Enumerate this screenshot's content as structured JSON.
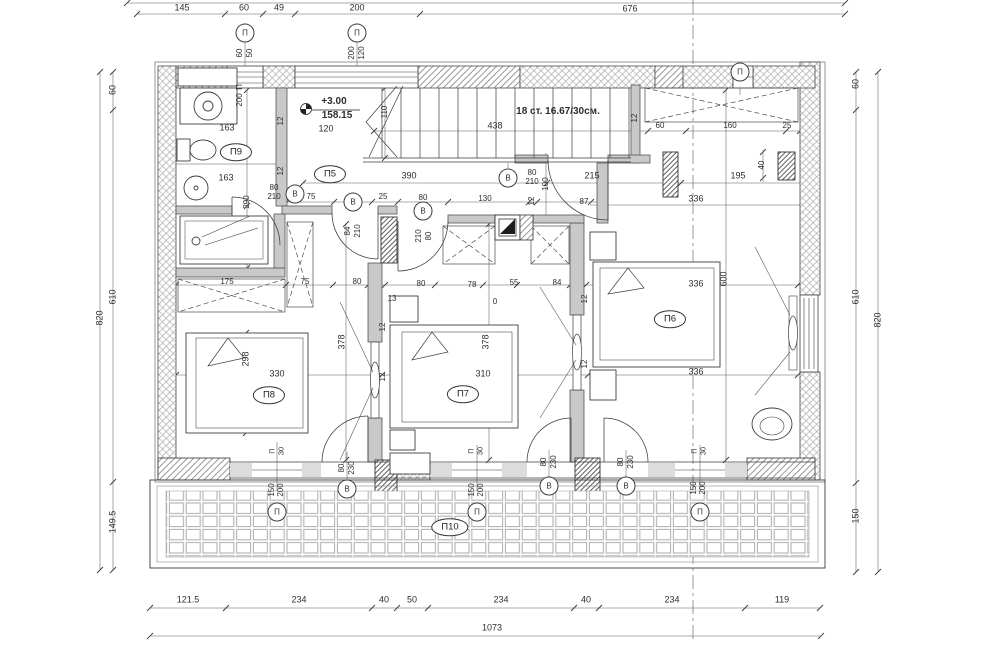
{
  "plan": {
    "title": "Floor plan +3.00 (second storey) with terrace",
    "level_mark": {
      "relative_elevation": "+3.00",
      "absolute_elevation": "158.15"
    },
    "stairs": {
      "note": "18 ст. 16.67/30см.",
      "run_length": "438",
      "flight_width": "110"
    },
    "overall": {
      "width_total": "1073",
      "height_total": "820"
    },
    "rooms": [
      {
        "id": "П5",
        "x": 330,
        "y": 174
      },
      {
        "id": "П6",
        "x": 670,
        "y": 319
      },
      {
        "id": "П7",
        "x": 463,
        "y": 394
      },
      {
        "id": "П8",
        "x": 269,
        "y": 395
      },
      {
        "id": "П9",
        "x": 236,
        "y": 152
      },
      {
        "id": "П10",
        "x": 450,
        "y": 527
      }
    ],
    "opening_marks": [
      {
        "symbol": "П",
        "x": 245,
        "y": 33
      },
      {
        "symbol": "П",
        "x": 357,
        "y": 33
      },
      {
        "symbol": "П",
        "x": 740,
        "y": 72
      },
      {
        "symbol": "П",
        "x": 277,
        "y": 512
      },
      {
        "symbol": "П",
        "x": 477,
        "y": 512
      },
      {
        "symbol": "П",
        "x": 700,
        "y": 512
      },
      {
        "symbol": "В",
        "x": 295,
        "y": 194
      },
      {
        "symbol": "В",
        "x": 353,
        "y": 202
      },
      {
        "symbol": "В",
        "x": 423,
        "y": 211
      },
      {
        "symbol": "В",
        "x": 508,
        "y": 178
      },
      {
        "symbol": "В",
        "x": 347,
        "y": 489
      },
      {
        "symbol": "В",
        "x": 549,
        "y": 486
      },
      {
        "symbol": "В",
        "x": 626,
        "y": 486
      }
    ],
    "texts": [
      {
        "n": "dim",
        "t": "145",
        "x": 182,
        "y": 8
      },
      {
        "n": "dim",
        "t": "60",
        "x": 244,
        "y": 8
      },
      {
        "n": "dim",
        "t": "49",
        "x": 279,
        "y": 8
      },
      {
        "n": "dim",
        "t": "200",
        "x": 357,
        "y": 8
      },
      {
        "n": "dim",
        "t": "676",
        "x": 630,
        "y": 9
      },
      {
        "n": "win-size",
        "t": "60",
        "x": 240,
        "y": 53,
        "v": 1,
        "s": 8
      },
      {
        "n": "win-size",
        "t": "50",
        "x": 250,
        "y": 53,
        "v": 1,
        "s": 8
      },
      {
        "n": "win-size",
        "t": "200",
        "x": 352,
        "y": 53,
        "v": 1,
        "s": 8
      },
      {
        "n": "win-size",
        "t": "120",
        "x": 362,
        "y": 53,
        "v": 1,
        "s": 8
      },
      {
        "n": "dim",
        "t": "820",
        "x": 100,
        "y": 318,
        "v": 1
      },
      {
        "n": "dim",
        "t": "60",
        "x": 113,
        "y": 90,
        "v": 1
      },
      {
        "n": "dim",
        "t": "610",
        "x": 113,
        "y": 297,
        "v": 1
      },
      {
        "n": "dim",
        "t": "149.5",
        "x": 113,
        "y": 522,
        "v": 1
      },
      {
        "n": "dim",
        "t": "60",
        "x": 856,
        "y": 84,
        "v": 1
      },
      {
        "n": "dim",
        "t": "610",
        "x": 856,
        "y": 297,
        "v": 1
      },
      {
        "n": "dim",
        "t": "150",
        "x": 856,
        "y": 516,
        "v": 1
      },
      {
        "n": "dim",
        "t": "820",
        "x": 878,
        "y": 320,
        "v": 1
      },
      {
        "n": "dim",
        "t": "121.5",
        "x": 188,
        "y": 600
      },
      {
        "n": "dim",
        "t": "234",
        "x": 299,
        "y": 600
      },
      {
        "n": "dim",
        "t": "40",
        "x": 384,
        "y": 600
      },
      {
        "n": "dim",
        "t": "50",
        "x": 412,
        "y": 600
      },
      {
        "n": "dim",
        "t": "234",
        "x": 501,
        "y": 600
      },
      {
        "n": "dim",
        "t": "40",
        "x": 586,
        "y": 600
      },
      {
        "n": "dim",
        "t": "234",
        "x": 672,
        "y": 600
      },
      {
        "n": "dim",
        "t": "119",
        "x": 782,
        "y": 600
      },
      {
        "n": "dim",
        "t": "1073",
        "x": 492,
        "y": 628
      },
      {
        "n": "level-relative",
        "t": "+3.00",
        "x": 334,
        "y": 102,
        "b": 1,
        "s": 10
      },
      {
        "n": "level-absolute",
        "t": "158.15",
        "x": 337,
        "y": 116,
        "b": 1,
        "s": 10
      },
      {
        "n": "stairs-note",
        "t": "18 ст. 16.67/30см.",
        "x": 558,
        "y": 112,
        "b": 1,
        "s": 10
      },
      {
        "n": "dim",
        "t": "438",
        "x": 495,
        "y": 126
      },
      {
        "n": "dim",
        "t": "110",
        "x": 385,
        "y": 112,
        "v": 1,
        "s": 8
      },
      {
        "n": "dim",
        "t": "12",
        "x": 635,
        "y": 118,
        "v": 1,
        "s": 8
      },
      {
        "n": "dim",
        "t": "163",
        "x": 227,
        "y": 128
      },
      {
        "n": "dim",
        "t": "163",
        "x": 226,
        "y": 178
      },
      {
        "n": "win-size",
        "t": "П",
        "x": 240,
        "y": 87,
        "v": 1,
        "s": 8
      },
      {
        "n": "win-size",
        "t": "200",
        "x": 240,
        "y": 100,
        "v": 1,
        "s": 8
      },
      {
        "n": "dim",
        "t": "12",
        "x": 281,
        "y": 121,
        "v": 1,
        "s": 8
      },
      {
        "n": "dim",
        "t": "12",
        "x": 281,
        "y": 171,
        "v": 1,
        "s": 8
      },
      {
        "n": "dim",
        "t": "120",
        "x": 326,
        "y": 129
      },
      {
        "n": "dim",
        "t": "290",
        "x": 247,
        "y": 202,
        "v": 1,
        "s": 8
      },
      {
        "n": "door-size",
        "t": "80",
        "x": 274,
        "y": 188,
        "s": 8
      },
      {
        "n": "door-size",
        "t": "210",
        "x": 274,
        "y": 197,
        "s": 8
      },
      {
        "n": "dim",
        "t": "75",
        "x": 311,
        "y": 197,
        "s": 8
      },
      {
        "n": "dim",
        "t": "25",
        "x": 383,
        "y": 197,
        "s": 8
      },
      {
        "n": "dim",
        "t": "80",
        "x": 423,
        "y": 198,
        "s": 8
      },
      {
        "n": "dim",
        "t": "130",
        "x": 485,
        "y": 199,
        "s": 8
      },
      {
        "n": "dim",
        "t": "12",
        "x": 532,
        "y": 201,
        "v": 1,
        "s": 8
      },
      {
        "n": "dim",
        "t": "87",
        "x": 584,
        "y": 202,
        "s": 8
      },
      {
        "n": "door-size",
        "t": "84",
        "x": 348,
        "y": 231,
        "v": 1,
        "s": 8
      },
      {
        "n": "door-size",
        "t": "210",
        "x": 358,
        "y": 231,
        "v": 1,
        "s": 8
      },
      {
        "n": "door-size",
        "t": "210",
        "x": 419,
        "y": 236,
        "v": 1,
        "s": 8
      },
      {
        "n": "door-size",
        "t": "80",
        "x": 429,
        "y": 236,
        "v": 1,
        "s": 8
      },
      {
        "n": "dim",
        "t": "390",
        "x": 409,
        "y": 176
      },
      {
        "n": "door-size",
        "t": "80",
        "x": 532,
        "y": 173,
        "s": 8
      },
      {
        "n": "door-size",
        "t": "210",
        "x": 532,
        "y": 182,
        "s": 8
      },
      {
        "n": "dim",
        "t": "100",
        "x": 546,
        "y": 184,
        "v": 1,
        "s": 8
      },
      {
        "n": "dim",
        "t": "215",
        "x": 592,
        "y": 176
      },
      {
        "n": "dim",
        "t": "195",
        "x": 738,
        "y": 176
      },
      {
        "n": "dim",
        "t": "40",
        "x": 762,
        "y": 165,
        "v": 1,
        "s": 8
      },
      {
        "n": "dim",
        "t": "336",
        "x": 696,
        "y": 199
      },
      {
        "n": "dim",
        "t": "60",
        "x": 660,
        "y": 126,
        "s": 8
      },
      {
        "n": "dim",
        "t": "160",
        "x": 730,
        "y": 126,
        "s": 8
      },
      {
        "n": "dim",
        "t": "25",
        "x": 787,
        "y": 126,
        "s": 8
      },
      {
        "n": "dim",
        "t": "175",
        "x": 227,
        "y": 282,
        "s": 8
      },
      {
        "n": "dim",
        "t": "75",
        "x": 305,
        "y": 282,
        "s": 8
      },
      {
        "n": "dim",
        "t": "80",
        "x": 357,
        "y": 282,
        "s": 8
      },
      {
        "n": "dim",
        "t": "80",
        "x": 421,
        "y": 284,
        "s": 8
      },
      {
        "n": "dim",
        "t": "78",
        "x": 472,
        "y": 285,
        "s": 8
      },
      {
        "n": "dim",
        "t": "55",
        "x": 514,
        "y": 283,
        "s": 8
      },
      {
        "n": "dim",
        "t": "84",
        "x": 557,
        "y": 283,
        "s": 8
      },
      {
        "n": "dim",
        "t": "0",
        "x": 495,
        "y": 302,
        "s": 8
      },
      {
        "n": "dim",
        "t": "13",
        "x": 392,
        "y": 299,
        "s": 8
      },
      {
        "n": "dim",
        "t": "336",
        "x": 696,
        "y": 284
      },
      {
        "n": "dim",
        "t": "600",
        "x": 724,
        "y": 279,
        "v": 1
      },
      {
        "n": "dim",
        "t": "336",
        "x": 696,
        "y": 372
      },
      {
        "n": "dim",
        "t": "378",
        "x": 342,
        "y": 342,
        "v": 1
      },
      {
        "n": "dim",
        "t": "378",
        "x": 486,
        "y": 342,
        "v": 1
      },
      {
        "n": "dim",
        "t": "298",
        "x": 246,
        "y": 359,
        "v": 1
      },
      {
        "n": "dim",
        "t": "330",
        "x": 277,
        "y": 374
      },
      {
        "n": "dim",
        "t": "310",
        "x": 483,
        "y": 374
      },
      {
        "n": "dim",
        "t": "12",
        "x": 383,
        "y": 327,
        "v": 1,
        "s": 8
      },
      {
        "n": "dim",
        "t": "12",
        "x": 383,
        "y": 377,
        "v": 1,
        "s": 8
      },
      {
        "n": "dim",
        "t": "12",
        "x": 585,
        "y": 299,
        "v": 1,
        "s": 8
      },
      {
        "n": "dim",
        "t": "12",
        "x": 585,
        "y": 364,
        "v": 1,
        "s": 8
      },
      {
        "n": "sill-mark",
        "t": "П",
        "x": 272,
        "y": 451,
        "v": 1,
        "s": 7.5
      },
      {
        "n": "sill-mark",
        "t": "30",
        "x": 281,
        "y": 451,
        "v": 1,
        "s": 7.5
      },
      {
        "n": "sill-mark",
        "t": "П",
        "x": 471,
        "y": 451,
        "v": 1,
        "s": 7.5
      },
      {
        "n": "sill-mark",
        "t": "30",
        "x": 480,
        "y": 451,
        "v": 1,
        "s": 7.5
      },
      {
        "n": "sill-mark",
        "t": "П",
        "x": 694,
        "y": 451,
        "v": 1,
        "s": 7.5
      },
      {
        "n": "sill-mark",
        "t": "30",
        "x": 703,
        "y": 451,
        "v": 1,
        "s": 7.5
      },
      {
        "n": "door-size",
        "t": "80",
        "x": 342,
        "y": 468,
        "v": 1,
        "s": 8
      },
      {
        "n": "door-size",
        "t": "230",
        "x": 352,
        "y": 468,
        "v": 1,
        "s": 8
      },
      {
        "n": "door-size",
        "t": "80",
        "x": 544,
        "y": 462,
        "v": 1,
        "s": 8
      },
      {
        "n": "door-size",
        "t": "230",
        "x": 554,
        "y": 462,
        "v": 1,
        "s": 8
      },
      {
        "n": "door-size",
        "t": "80",
        "x": 621,
        "y": 462,
        "v": 1,
        "s": 8
      },
      {
        "n": "door-size",
        "t": "230",
        "x": 631,
        "y": 462,
        "v": 1,
        "s": 8
      },
      {
        "n": "win-size",
        "t": "150",
        "x": 272,
        "y": 490,
        "v": 1,
        "s": 8
      },
      {
        "n": "win-size",
        "t": "200",
        "x": 281,
        "y": 490,
        "v": 1,
        "s": 8
      },
      {
        "n": "win-size",
        "t": "150",
        "x": 472,
        "y": 490,
        "v": 1,
        "s": 8
      },
      {
        "n": "win-size",
        "t": "200",
        "x": 481,
        "y": 490,
        "v": 1,
        "s": 8
      },
      {
        "n": "win-size",
        "t": "150",
        "x": 694,
        "y": 488,
        "v": 1,
        "s": 8
      },
      {
        "n": "win-size",
        "t": "200",
        "x": 703,
        "y": 488,
        "v": 1,
        "s": 8
      }
    ]
  }
}
